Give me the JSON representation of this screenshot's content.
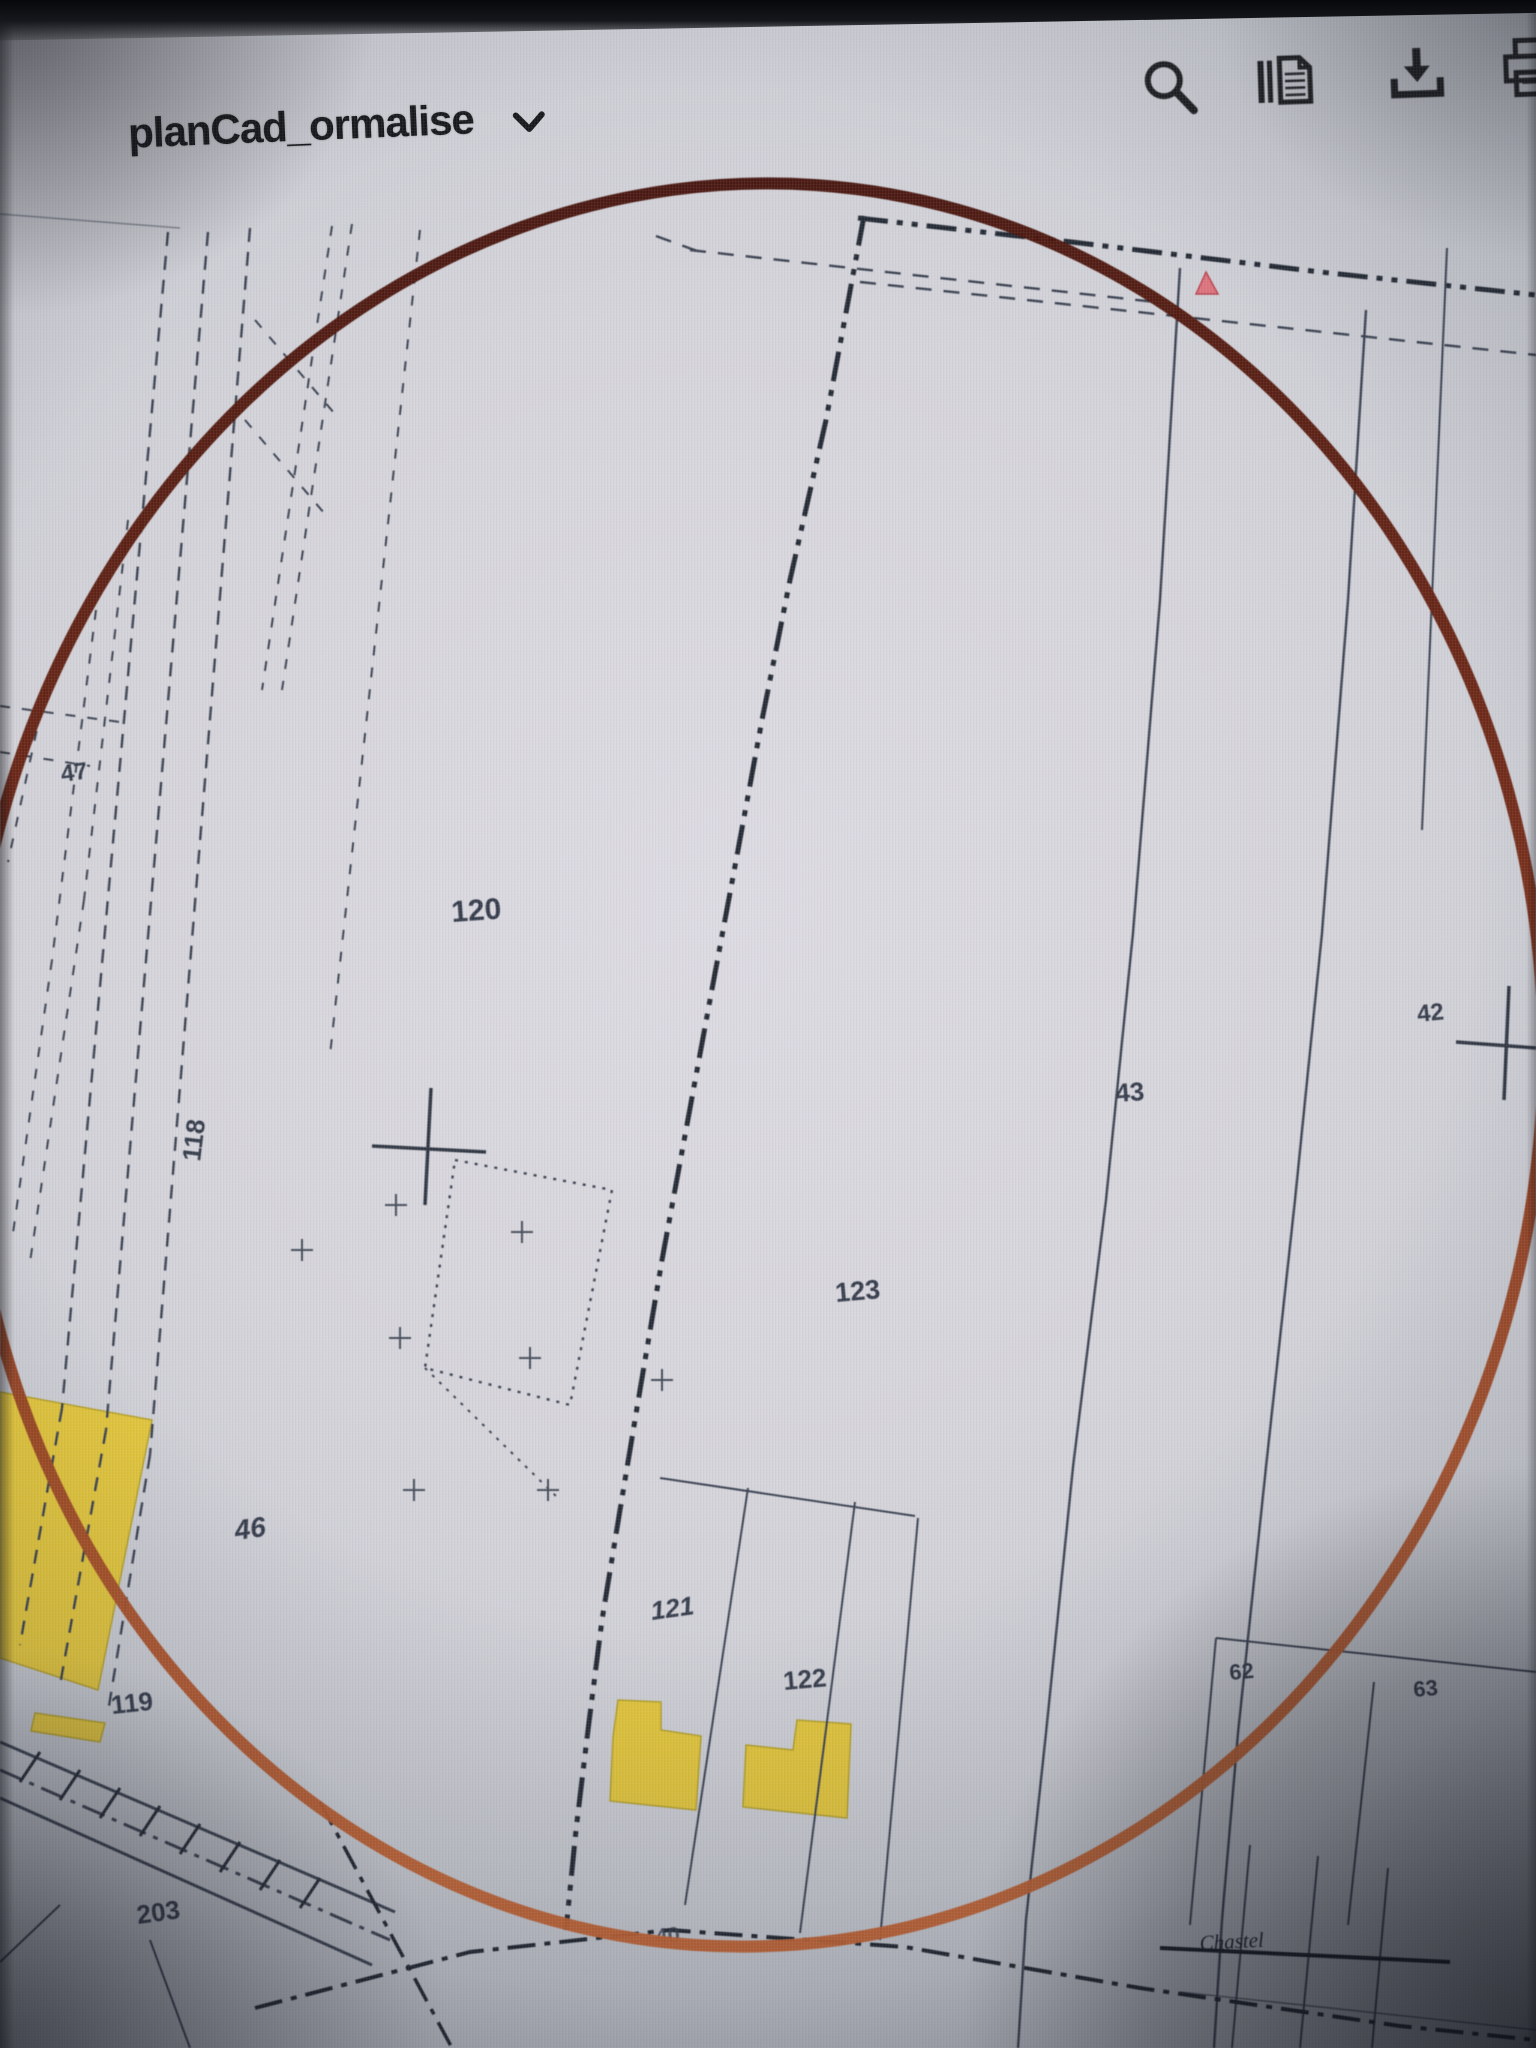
{
  "window": {
    "title": "planCad_ormalise"
  },
  "toolbar": {
    "buttons": [
      {
        "name": "search",
        "icon": "magnifier-icon"
      },
      {
        "name": "pages",
        "icon": "document-copy-icon"
      },
      {
        "name": "download",
        "icon": "download-arrow-icon"
      },
      {
        "name": "print",
        "icon": "printer-icon"
      }
    ]
  },
  "map": {
    "parcel_labels": {
      "p47": "47",
      "p120": "120",
      "p118": "118",
      "p42": "42",
      "p43": "43",
      "p123": "123",
      "p46": "46",
      "p121": "121",
      "p122": "122",
      "p62": "62",
      "p63": "63",
      "p119": "119",
      "p203": "203",
      "p40": "40"
    },
    "place_labels": {
      "chastel": "Chastel"
    },
    "annotation": {
      "type": "hand-drawn-circle",
      "color_top": "#3d0e08",
      "color_bottom": "#c26231"
    },
    "colors": {
      "building_fill": "#e2c53b",
      "marker_pink": "#dc737d",
      "linework": "#3a4150",
      "paper": "#d6d5db"
    }
  }
}
